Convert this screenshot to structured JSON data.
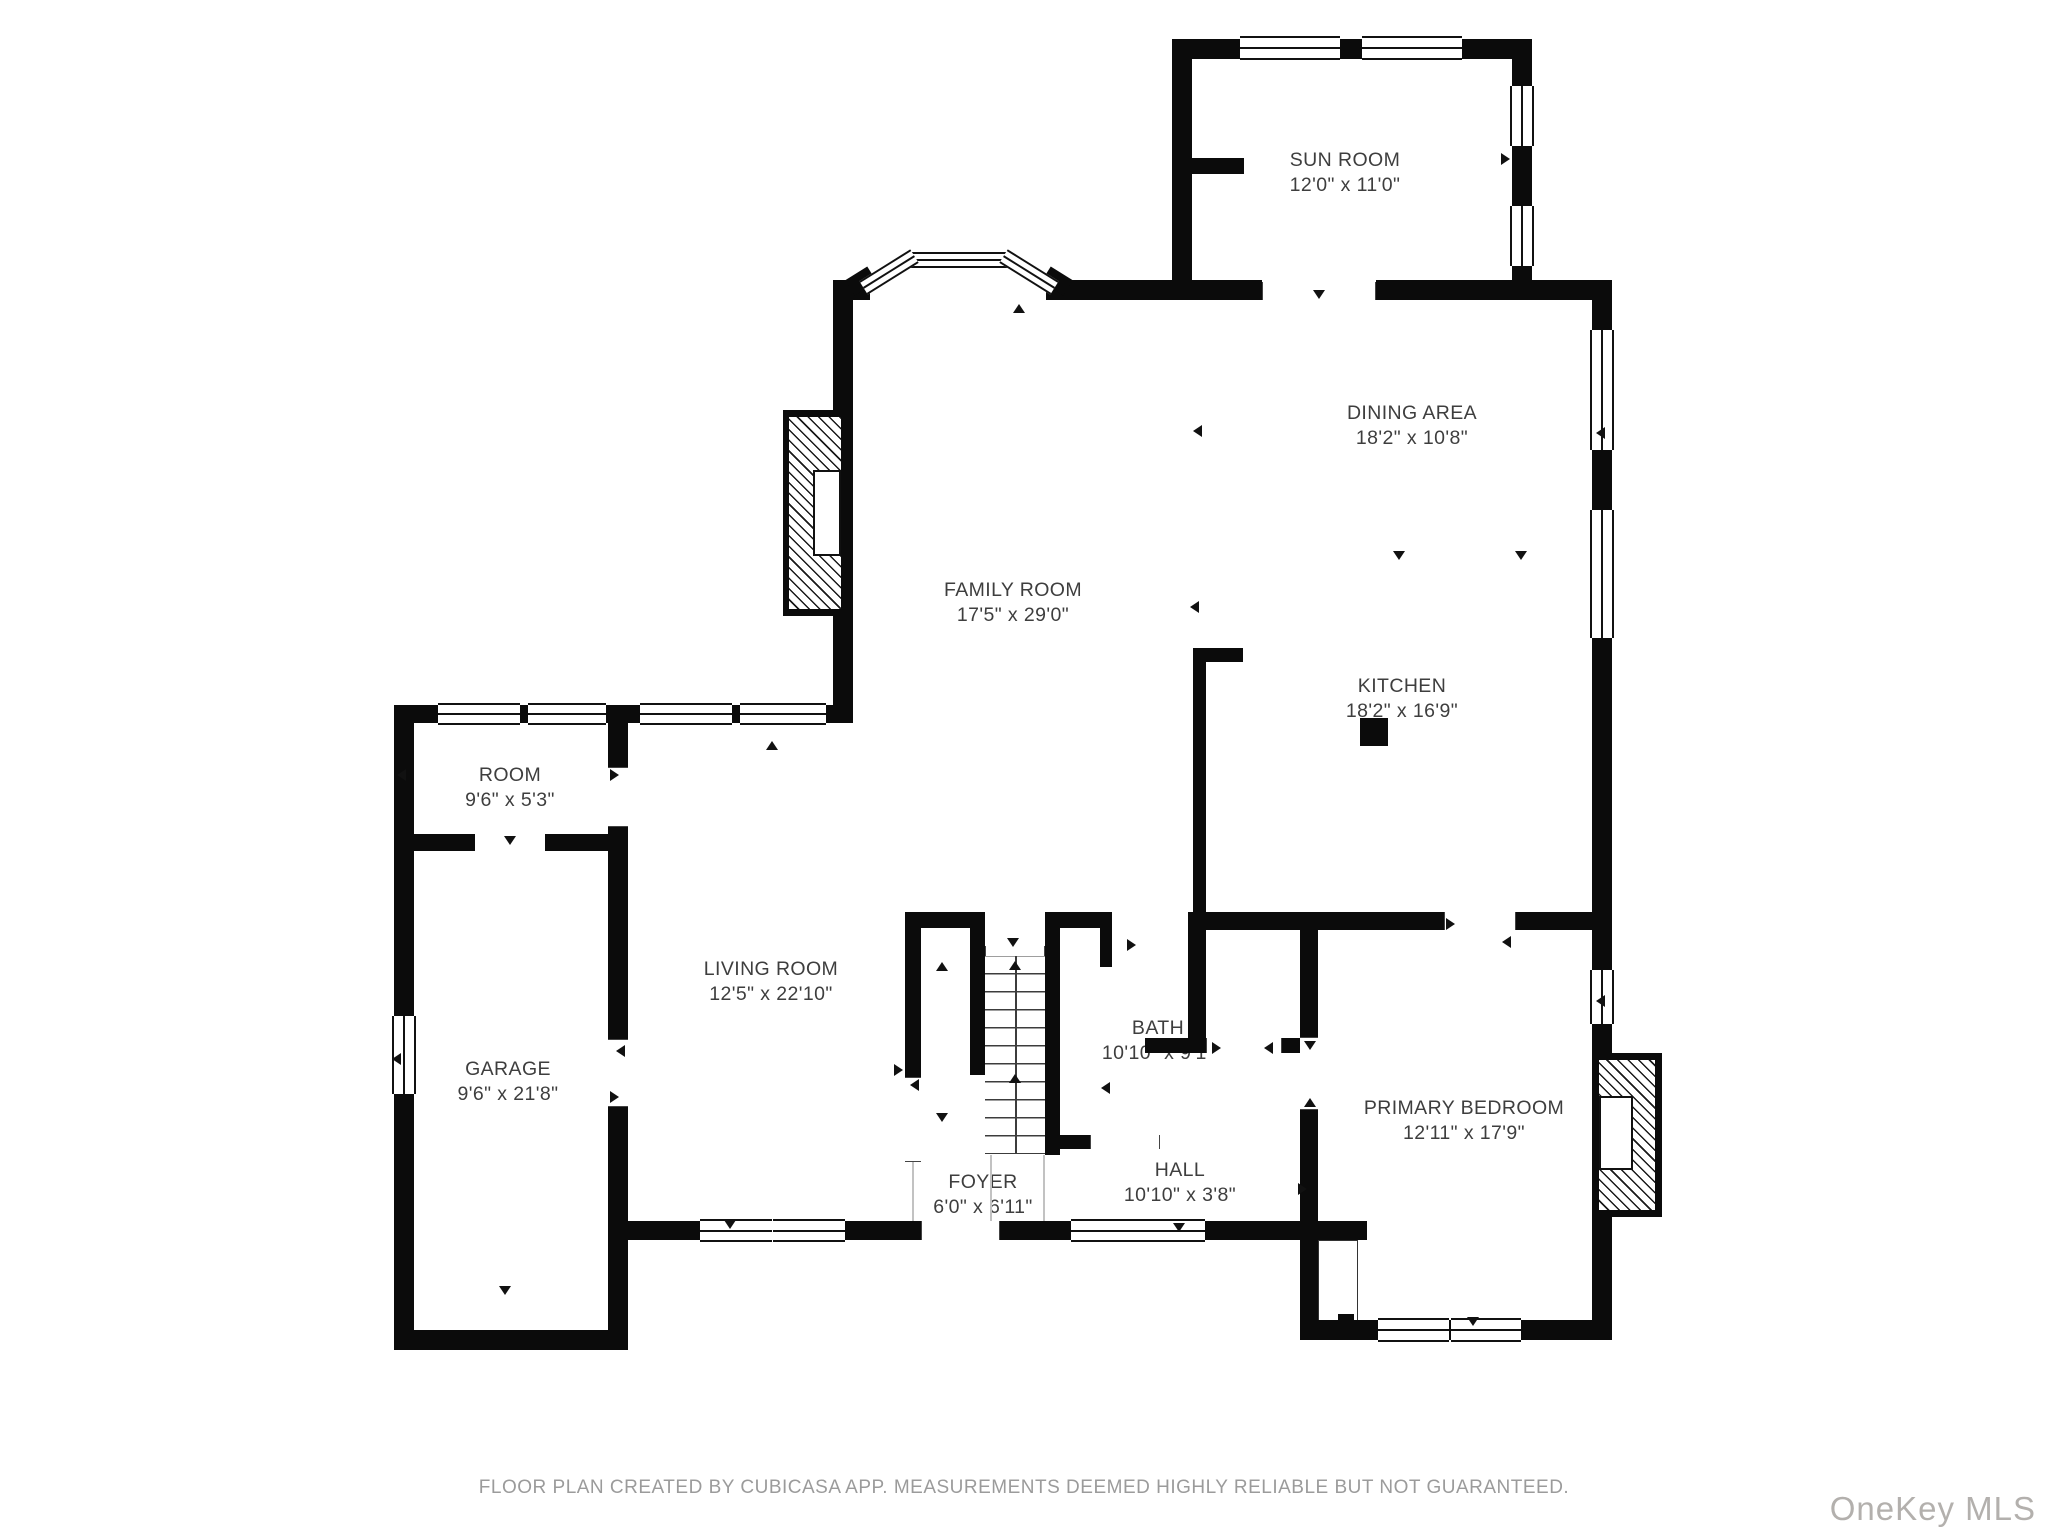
{
  "rooms": [
    {
      "id": "sun-room",
      "name": "SUN ROOM",
      "dims": "12'0\" x 11'0\"",
      "cx": 1345,
      "cy": 160
    },
    {
      "id": "dining-area",
      "name": "DINING AREA",
      "dims": "18'2\" x 10'8\"",
      "cx": 1412,
      "cy": 413
    },
    {
      "id": "family-room",
      "name": "FAMILY ROOM",
      "dims": "17'5\" x 29'0\"",
      "cx": 1013,
      "cy": 590
    },
    {
      "id": "kitchen",
      "name": "KITCHEN",
      "dims": "18'2\" x 16'9\"",
      "cx": 1402,
      "cy": 686
    },
    {
      "id": "room",
      "name": "ROOM",
      "dims": "9'6\" x 5'3\"",
      "cx": 510,
      "cy": 775
    },
    {
      "id": "living-room",
      "name": "LIVING ROOM",
      "dims": "12'5\" x 22'10\"",
      "cx": 771,
      "cy": 969
    },
    {
      "id": "garage",
      "name": "GARAGE",
      "dims": "9'6\" x 21'8\"",
      "cx": 508,
      "cy": 1069
    },
    {
      "id": "bath",
      "name": "BATH",
      "dims": "10'10\" x 9'1\"",
      "cx": 1158,
      "cy": 1028
    },
    {
      "id": "foyer",
      "name": "FOYER",
      "dims": "6'0\" x 6'11\"",
      "cx": 983,
      "cy": 1182
    },
    {
      "id": "hall",
      "name": "HALL",
      "dims": "10'10\" x 3'8\"",
      "cx": 1180,
      "cy": 1170
    },
    {
      "id": "primary-bedroom",
      "name": "PRIMARY BEDROOM",
      "dims": "12'11\" x 17'9\"",
      "cx": 1464,
      "cy": 1108
    }
  ],
  "footer": {
    "disclaimer": "FLOOR PLAN CREATED BY CUBICASA APP. MEASUREMENTS DEEMED HIGHLY RELIABLE BUT NOT GUARANTEED.",
    "watermark": "OneKey MLS"
  },
  "colors": {
    "wall": "#0b0b0b",
    "label": "#3e3e3e",
    "disclaimer": "#9b9b9b",
    "watermark": "#b3b0ad"
  },
  "geometry": {
    "walls": [
      [
        1172,
        39,
        360,
        20
      ],
      [
        1172,
        39,
        20,
        261
      ],
      [
        1512,
        39,
        20,
        261
      ],
      [
        1192,
        158,
        52,
        16
      ],
      [
        833,
        280,
        37,
        20
      ],
      [
        1046,
        280,
        146,
        20
      ],
      [
        1192,
        280,
        70,
        20
      ],
      [
        1376,
        280,
        236,
        20
      ],
      [
        1592,
        280,
        20,
        1060
      ],
      [
        833,
        300,
        20,
        423
      ],
      [
        394,
        705,
        459,
        18
      ],
      [
        394,
        705,
        20,
        645
      ],
      [
        394,
        1330,
        234,
        20
      ],
      [
        608,
        705,
        20,
        62
      ],
      [
        608,
        827,
        20,
        212
      ],
      [
        608,
        1107,
        20,
        243
      ],
      [
        613,
        1221,
        87,
        19
      ],
      [
        845,
        1221,
        76,
        19
      ],
      [
        1000,
        1221,
        71,
        19
      ],
      [
        1205,
        1221,
        162,
        19
      ],
      [
        394,
        834,
        81,
        17
      ],
      [
        545,
        834,
        83,
        17
      ],
      [
        905,
        912,
        80,
        16
      ],
      [
        905,
        912,
        16,
        165
      ],
      [
        970,
        912,
        15,
        163
      ],
      [
        1045,
        912,
        15,
        243
      ],
      [
        1045,
        912,
        65,
        16
      ],
      [
        1100,
        912,
        12,
        55
      ],
      [
        1188,
        928,
        18,
        112
      ],
      [
        1145,
        1038,
        63,
        15
      ],
      [
        1282,
        1038,
        18,
        15
      ],
      [
        1052,
        1135,
        38,
        14
      ],
      [
        1188,
        912,
        256,
        18
      ],
      [
        1516,
        912,
        96,
        18
      ],
      [
        1193,
        648,
        13,
        270
      ],
      [
        1193,
        648,
        50,
        14
      ],
      [
        1300,
        928,
        18,
        109
      ],
      [
        1300,
        1110,
        18,
        230
      ],
      [
        1300,
        1320,
        312,
        20
      ],
      [
        1338,
        1314,
        16,
        12
      ]
    ],
    "windows": [
      {
        "x": 1240,
        "y": 36,
        "w": 100,
        "h": 24,
        "o": "h"
      },
      {
        "x": 1362,
        "y": 36,
        "w": 100,
        "h": 24,
        "o": "h"
      },
      {
        "x": 1510,
        "y": 86,
        "w": 24,
        "h": 60,
        "o": "v"
      },
      {
        "x": 1510,
        "y": 206,
        "w": 24,
        "h": 60,
        "o": "v"
      },
      {
        "x": 1590,
        "y": 330,
        "w": 24,
        "h": 120,
        "o": "v"
      },
      {
        "x": 1590,
        "y": 510,
        "w": 24,
        "h": 128,
        "o": "v"
      },
      {
        "x": 1590,
        "y": 970,
        "w": 24,
        "h": 54,
        "o": "v"
      },
      {
        "x": 438,
        "y": 703,
        "w": 82,
        "h": 22,
        "o": "h"
      },
      {
        "x": 528,
        "y": 703,
        "w": 78,
        "h": 22,
        "o": "h"
      },
      {
        "x": 640,
        "y": 703,
        "w": 92,
        "h": 22,
        "o": "h"
      },
      {
        "x": 740,
        "y": 703,
        "w": 86,
        "h": 22,
        "o": "h"
      },
      {
        "x": 392,
        "y": 1016,
        "w": 24,
        "h": 78,
        "o": "v"
      },
      {
        "x": 700,
        "y": 1219,
        "w": 72,
        "h": 23,
        "o": "h"
      },
      {
        "x": 773,
        "y": 1219,
        "w": 72,
        "h": 23,
        "o": "h"
      },
      {
        "x": 1071,
        "y": 1219,
        "w": 67,
        "h": 23,
        "o": "h"
      },
      {
        "x": 1138,
        "y": 1219,
        "w": 67,
        "h": 23,
        "o": "h"
      },
      {
        "x": 1378,
        "y": 1318,
        "w": 71,
        "h": 24,
        "o": "h"
      },
      {
        "x": 1451,
        "y": 1318,
        "w": 70,
        "h": 24,
        "o": "h"
      },
      {
        "x": 910,
        "y": 252,
        "w": 98,
        "h": 16,
        "o": "h"
      }
    ],
    "angled": [
      {
        "cx": 889,
        "cy": 272,
        "len": 60,
        "deg": -32,
        "type": "win"
      },
      {
        "cx": 1029,
        "cy": 272,
        "len": 60,
        "deg": 32,
        "type": "win"
      },
      {
        "cx": 861,
        "cy": 281,
        "len": 26,
        "deg": -32,
        "type": "wall"
      },
      {
        "cx": 1057,
        "cy": 281,
        "len": 26,
        "deg": 32,
        "type": "wall"
      }
    ],
    "gaps": [
      {
        "x": 1262,
        "y": 282,
        "w": 114,
        "h": 18,
        "o": "h"
      },
      {
        "x": 921,
        "y": 1221,
        "w": 79,
        "h": 19,
        "o": "h"
      },
      {
        "x": 1444,
        "y": 912,
        "w": 72,
        "h": 18,
        "o": "h"
      },
      {
        "x": 608,
        "y": 1039,
        "w": 20,
        "h": 68,
        "o": "v"
      },
      {
        "x": 608,
        "y": 767,
        "w": 20,
        "h": 60,
        "o": "v"
      },
      {
        "x": 1300,
        "y": 1037,
        "w": 18,
        "h": 73,
        "o": "v"
      },
      {
        "x": 905,
        "y": 1077,
        "w": 16,
        "h": 85,
        "o": "v"
      },
      {
        "x": 1206,
        "y": 1038,
        "w": 76,
        "h": 15,
        "o": "h"
      },
      {
        "x": 1090,
        "y": 1135,
        "w": 70,
        "h": 14,
        "o": "h"
      },
      {
        "x": 985,
        "y": 946,
        "w": 60,
        "h": 10,
        "o": "h"
      }
    ],
    "triangles": [
      {
        "x": 1319,
        "y": 295,
        "d": "down"
      },
      {
        "x": 1507,
        "y": 158,
        "d": "right"
      },
      {
        "x": 1019,
        "y": 309,
        "d": "up"
      },
      {
        "x": 1199,
        "y": 430,
        "d": "left"
      },
      {
        "x": 1602,
        "y": 432,
        "d": "left"
      },
      {
        "x": 1399,
        "y": 556,
        "d": "down"
      },
      {
        "x": 1521,
        "y": 556,
        "d": "down"
      },
      {
        "x": 1196,
        "y": 606,
        "d": "left"
      },
      {
        "x": 403,
        "y": 774,
        "d": "left"
      },
      {
        "x": 616,
        "y": 774,
        "d": "right"
      },
      {
        "x": 510,
        "y": 841,
        "d": "down"
      },
      {
        "x": 398,
        "y": 1058,
        "d": "left"
      },
      {
        "x": 622,
        "y": 1050,
        "d": "left"
      },
      {
        "x": 616,
        "y": 1096,
        "d": "right"
      },
      {
        "x": 505,
        "y": 1291,
        "d": "down"
      },
      {
        "x": 772,
        "y": 746,
        "d": "up"
      },
      {
        "x": 730,
        "y": 1225,
        "d": "down"
      },
      {
        "x": 942,
        "y": 967,
        "d": "up"
      },
      {
        "x": 942,
        "y": 1118,
        "d": "down"
      },
      {
        "x": 900,
        "y": 1069,
        "d": "right"
      },
      {
        "x": 916,
        "y": 1084,
        "d": "left"
      },
      {
        "x": 1013,
        "y": 943,
        "d": "down"
      },
      {
        "x": 1133,
        "y": 944,
        "d": "right"
      },
      {
        "x": 1107,
        "y": 1087,
        "d": "left"
      },
      {
        "x": 1218,
        "y": 1047,
        "d": "right"
      },
      {
        "x": 1270,
        "y": 1047,
        "d": "left"
      },
      {
        "x": 1310,
        "y": 1046,
        "d": "down"
      },
      {
        "x": 1310,
        "y": 1103,
        "d": "up"
      },
      {
        "x": 1452,
        "y": 923,
        "d": "right"
      },
      {
        "x": 1508,
        "y": 941,
        "d": "left"
      },
      {
        "x": 1179,
        "y": 1228,
        "d": "down"
      },
      {
        "x": 1304,
        "y": 1188,
        "d": "right"
      },
      {
        "x": 1473,
        "y": 1322,
        "d": "down"
      },
      {
        "x": 1602,
        "y": 1000,
        "d": "left"
      },
      {
        "x": 1015,
        "y": 966,
        "d": "up"
      },
      {
        "x": 1015,
        "y": 1079,
        "d": "up"
      }
    ],
    "stairs": {
      "x": 985,
      "y": 955,
      "w": 60,
      "h": 198
    },
    "fireplaces": [
      {
        "x": 783,
        "y": 410,
        "w": 64,
        "h": 206,
        "hatch": {
          "x": 789,
          "y": 417,
          "w": 52,
          "h": 192
        },
        "box": {
          "x": 813,
          "y": 470,
          "w": 28,
          "h": 86
        }
      },
      {
        "x": 1592,
        "y": 1053,
        "w": 70,
        "h": 164,
        "hatch": {
          "x": 1599,
          "y": 1060,
          "w": 56,
          "h": 150
        },
        "box": {
          "x": 1599,
          "y": 1096,
          "w": 34,
          "h": 74
        }
      }
    ],
    "pillars": [
      {
        "x": 1360,
        "y": 718,
        "w": 28,
        "h": 28
      }
    ],
    "closets": [
      {
        "x": 1318,
        "y": 1240,
        "w": 40,
        "h": 84
      }
    ],
    "thin_lines": [
      {
        "x": 990,
        "y": 1155,
        "w": 1.5,
        "h": 66
      },
      {
        "x": 1043,
        "y": 1155,
        "w": 1.5,
        "h": 66
      },
      {
        "x": 912,
        "y": 1162,
        "w": 1.5,
        "h": 59
      }
    ]
  }
}
